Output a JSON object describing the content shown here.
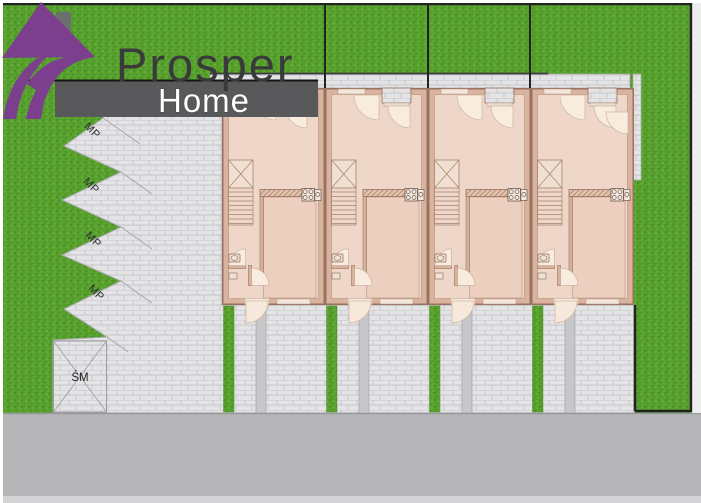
{
  "brand": {
    "title": "Prosper",
    "subtitle": "Home"
  },
  "site_plan": {
    "parking_space_labels": [
      "MP",
      "MP",
      "MP",
      "MP"
    ],
    "waste_area_label": "ŚM",
    "house_units": [
      "unit-1",
      "unit-2",
      "unit-3",
      "unit-4"
    ],
    "unit_count": 4,
    "colors": {
      "logo_purple": "#7c3f8e",
      "banner_gray": "#59595b",
      "title_gray": "#3a3a3c",
      "grass_green": "#57a02e",
      "paving_gray": "#e3e3e5",
      "walkway_gray": "#c7c7c9",
      "road_gray": "#b6b6b8",
      "wall_tan": "#d9b39d",
      "floor_pink": "#eed7c8",
      "fence_black": "#222222"
    }
  }
}
